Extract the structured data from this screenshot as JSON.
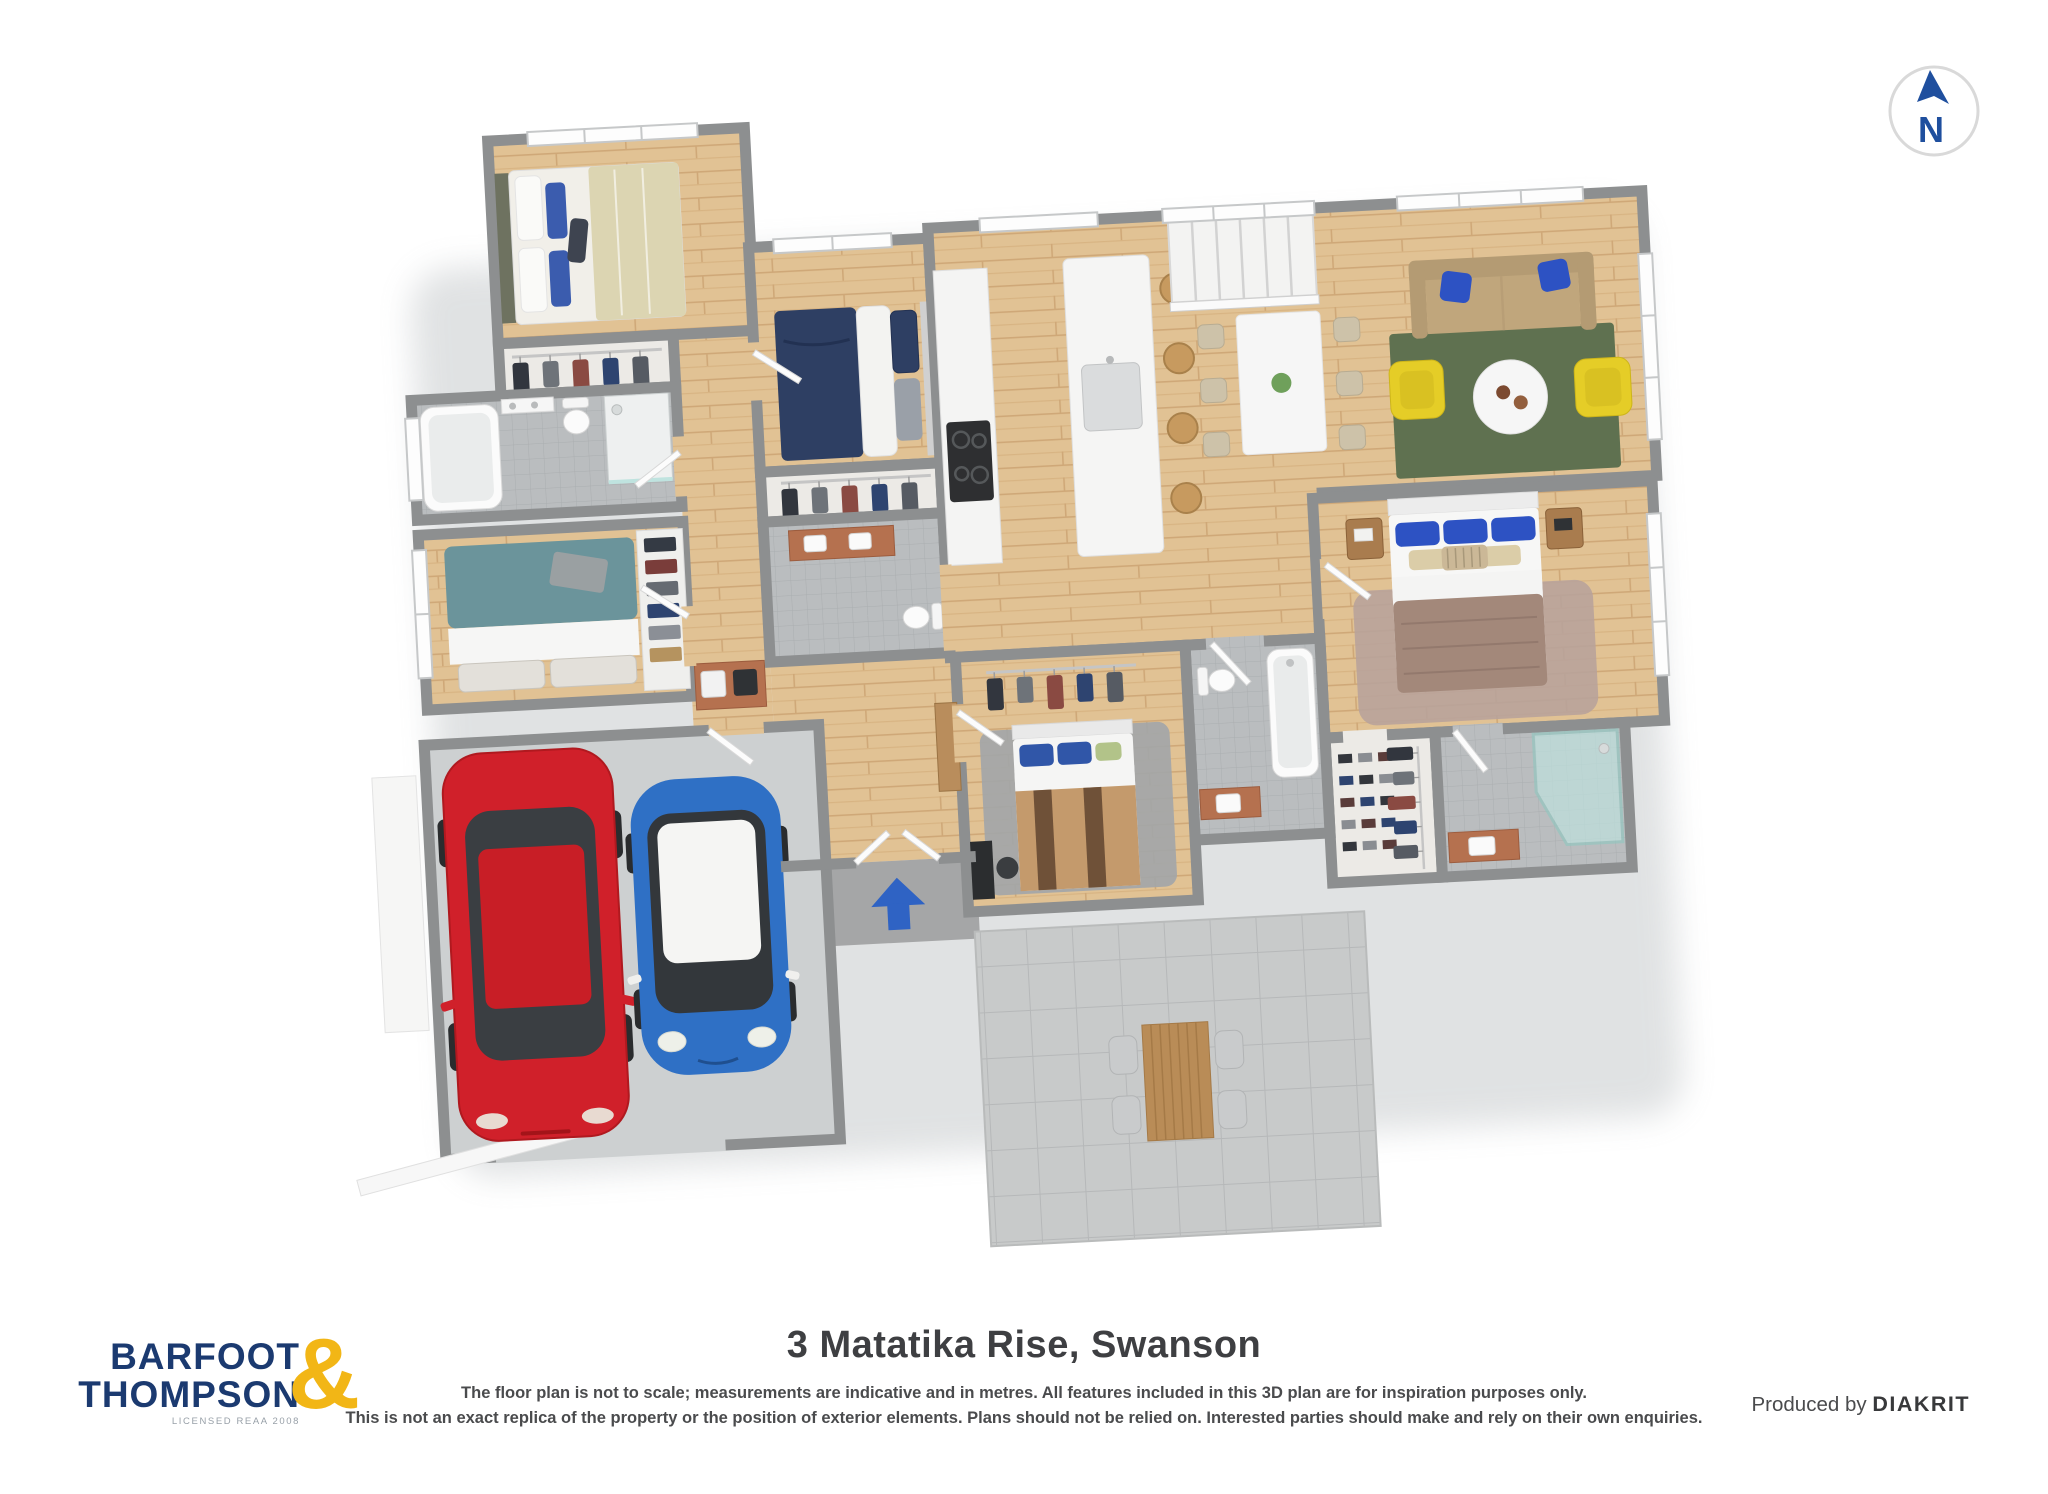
{
  "compass": {
    "label": "N"
  },
  "footer": {
    "title": "3 Matatika Rise, Swanson",
    "disclaimer_line1": "The floor plan is not to scale; measurements are indicative and in metres. All features included in this 3D plan are for inspiration purposes only.",
    "disclaimer_line2": "This is not an exact replica of the property or the position of exterior elements. Plans should not be relied on. Interested parties should make and rely on their own enquiries.",
    "produced_by": "Produced by",
    "producer": "DIAKRIT",
    "logo": {
      "line1": "BARFOOT",
      "line2": "THOMPSON",
      "ampersand": "&",
      "sub": "LICENSED REAA 2008"
    }
  },
  "colors": {
    "brandNavy": "#1b3a70",
    "brandGold": "#f2b616",
    "compassBlue": "#1f4f9e",
    "arrowBlue": "#2f63c4",
    "wall": "#8d8f90",
    "carRed": "#d0202a",
    "carBlue": "#2f70c5",
    "sofaTan": "#c0a67c",
    "rugGreen": "#5f7150",
    "armchairYellow": "#e5cd27",
    "bedTeal": "#6b949b",
    "bedNavy": "#2e3f63",
    "bedStripeTan": "#c49a6c",
    "bedStripeBrown": "#6f5138",
    "masterDuvet": "#a3887a",
    "rugMauve": "#b7a29b",
    "rugGray": "#a3a6a8",
    "counterBrick": "#b5714f",
    "showerGlass": "#bfe3df",
    "pillowBlue": "#2d52c3"
  },
  "floorplan": {
    "rooms": [
      "bedroom-top-left",
      "closet",
      "bathroom-left",
      "bedroom-left",
      "garage",
      "hallway",
      "bedroom-middle",
      "kitchen",
      "stairs",
      "dining-area",
      "living-room",
      "master-bedroom",
      "walk-in-closet",
      "ensuite",
      "bathroom-middle",
      "bedroom-lower-middle",
      "laundry-nook",
      "entry-porch",
      "patio"
    ],
    "vehicles": [
      "red-sedan",
      "blue-hatchback-with-white-roof"
    ],
    "features": [
      "north-compass",
      "entry-arrow",
      "outdoor-dining-table",
      "kitchen-island-with-stools",
      "corner-shower",
      "bathtubs",
      "wardrobes-with-clothes"
    ]
  }
}
